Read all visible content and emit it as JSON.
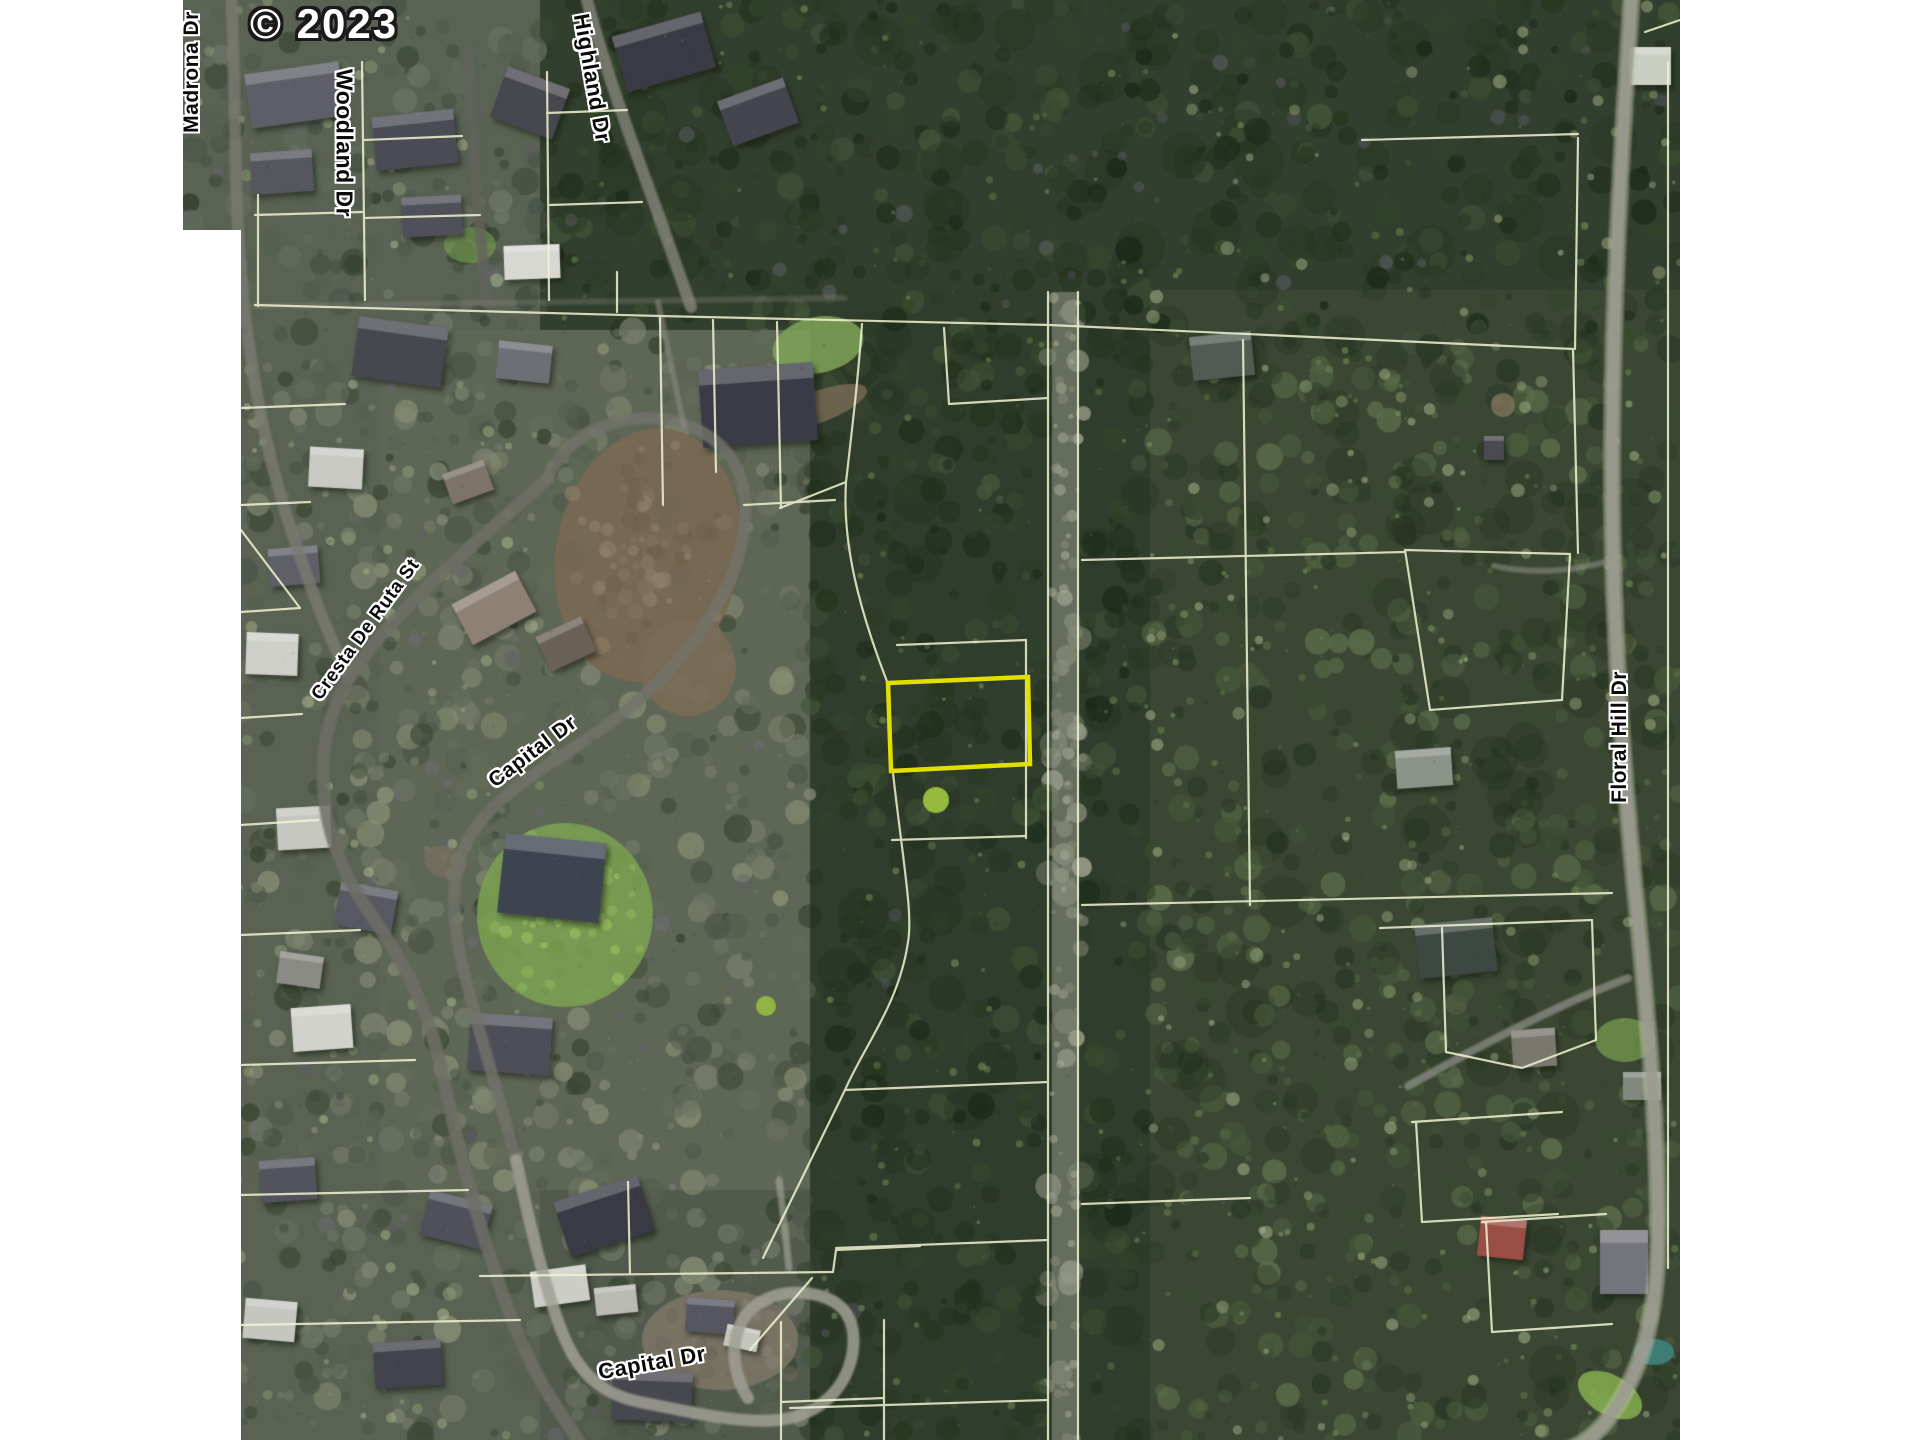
{
  "map": {
    "copyright": "© 2023",
    "streets": [
      {
        "name": "Madrona Dr"
      },
      {
        "name": "Woodland Dr"
      },
      {
        "name": "Highland Dr"
      },
      {
        "name": "Cresta De Ruta St"
      },
      {
        "name": "Capital Dr"
      },
      {
        "name": "Capital Dr"
      },
      {
        "name": "Floral Hill Dr"
      }
    ],
    "subject_parcel": {
      "outline_color": "#e2de00"
    },
    "colors": {
      "parcel_line": "#f0f4d2",
      "road": "#78786f",
      "label_text": "#0a0a0a",
      "label_halo": "#ffffff",
      "watermark_text": "#ffffff"
    }
  }
}
